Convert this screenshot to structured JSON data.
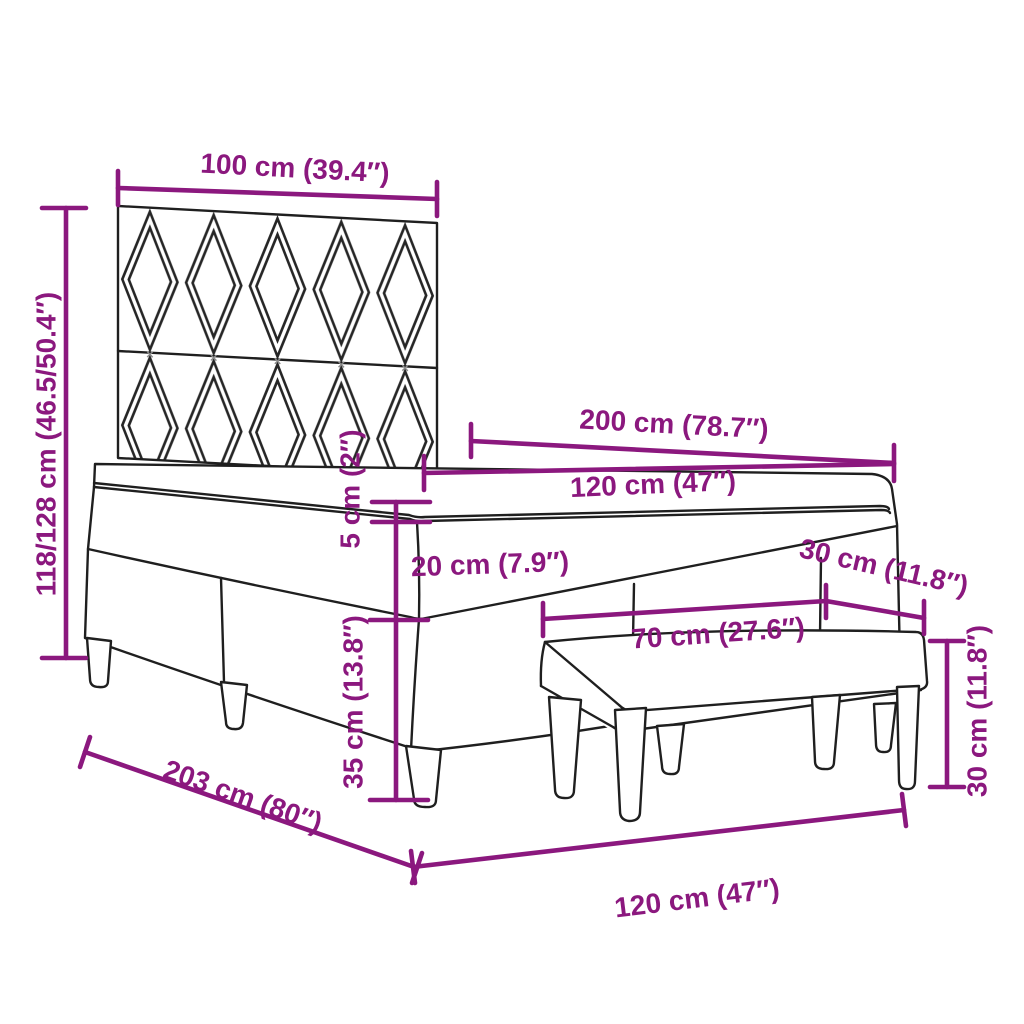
{
  "diagram": {
    "kind": "furniture-dimension-diagram",
    "colors": {
      "accent": "#8B187E",
      "line": "#1F1F1F",
      "background": "#FFFFFF"
    },
    "stitch_mark": "×",
    "dims": {
      "headboard_width": "100 cm (39.4″)",
      "overall_height": "118/128 cm (46.5/50.4″)",
      "bed_length": "200 cm (78.7″)",
      "bed_width_top": "120 cm (47″)",
      "topper_thickness": "5 cm (2″)",
      "mattress_thickness": "20 cm (7.9″)",
      "base_height": "35 cm (13.8″)",
      "bench_depth": "30 cm (11.8″)",
      "bench_length": "70 cm (27.6″)",
      "bench_height": "30 cm (11.8″)",
      "base_length": "203 cm (80″)",
      "base_width_bottom": "120 cm (47″)"
    }
  }
}
